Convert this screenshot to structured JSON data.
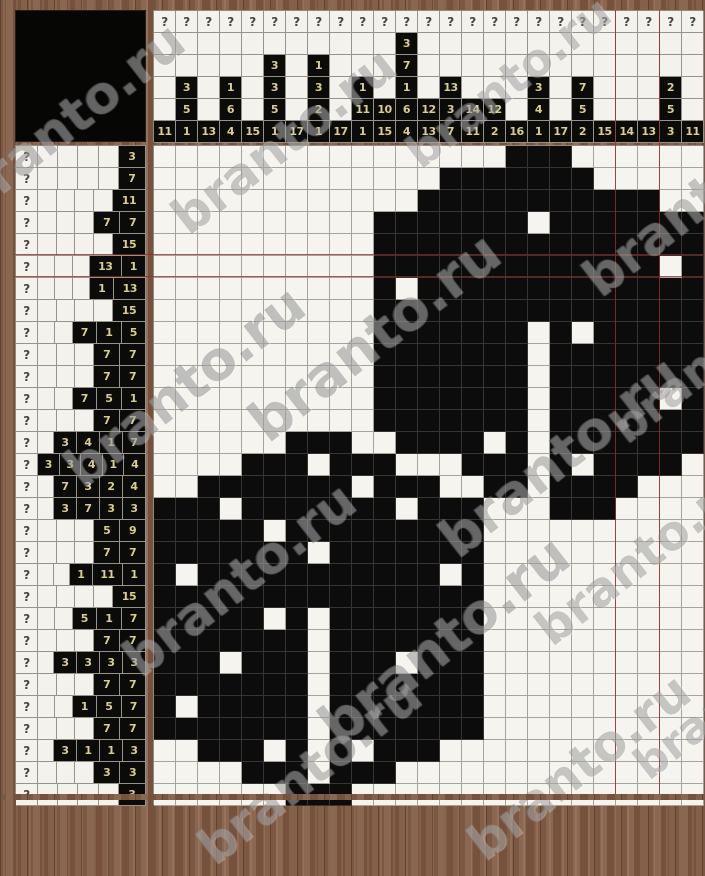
{
  "site": {
    "watermark_text": "branto.ru"
  },
  "puzzle": {
    "rows": 30,
    "cols": 25,
    "hidden_clue_symbol": "?",
    "column_clues": [
      [
        11
      ],
      [
        3,
        5,
        1
      ],
      [
        13
      ],
      [
        1,
        6,
        4
      ],
      [
        15
      ],
      [
        3,
        3,
        5,
        1
      ],
      [
        17
      ],
      [
        1,
        3,
        2,
        1
      ],
      [
        17
      ],
      [
        1,
        11,
        1
      ],
      [
        10,
        15
      ],
      [
        3,
        7,
        1,
        6,
        4
      ],
      [
        12,
        13
      ],
      [
        13,
        3,
        7
      ],
      [
        14,
        11
      ],
      [
        12,
        2
      ],
      [
        16
      ],
      [
        3,
        4,
        1
      ],
      [
        17
      ],
      [
        7,
        5,
        2
      ],
      [
        15
      ],
      [
        14
      ],
      [
        13
      ],
      [
        2,
        5,
        3
      ],
      [
        11
      ]
    ],
    "row_clues": [
      [
        3
      ],
      [
        7
      ],
      [
        11
      ],
      [
        7,
        7
      ],
      [
        15
      ],
      [
        13,
        1
      ],
      [
        1,
        13
      ],
      [
        15
      ],
      [
        7,
        1,
        5
      ],
      [
        7,
        7
      ],
      [
        7,
        7
      ],
      [
        7,
        5,
        1
      ],
      [
        7,
        7
      ],
      [
        3,
        4,
        1,
        7
      ],
      [
        3,
        3,
        4,
        1,
        4
      ],
      [
        7,
        3,
        2,
        4
      ],
      [
        3,
        7,
        3,
        3
      ],
      [
        5,
        9
      ],
      [
        7,
        7
      ],
      [
        1,
        11,
        1
      ],
      [
        15
      ],
      [
        5,
        1,
        7
      ],
      [
        7,
        7
      ],
      [
        3,
        3,
        3,
        3
      ],
      [
        7,
        7
      ],
      [
        1,
        5,
        7
      ],
      [
        7,
        7
      ],
      [
        3,
        1,
        1,
        3
      ],
      [
        3,
        3
      ],
      [
        3
      ]
    ],
    "grid": [
      "0000000000000000111000000",
      "0000000000000111111100000",
      "0000000000001111111111100",
      "0000000000111111101111111",
      "0000000000111111111111111",
      "0000000000111111111111101",
      "0000000000101111111111111",
      "0000000000111111111111111",
      "0000000000111111101011111",
      "0000000000111111101111111",
      "0000000000111111101111111",
      "0000000000111111101111101",
      "0000000000111111101111111",
      "0000001110011110101111111",
      "0000111011100011101011110",
      "0011111110111001101111000",
      "1110111111101110001110000",
      "1111101111111110000000000",
      "1111111011111110000000000",
      "1011111111111010000000000",
      "1111111111111110000000000",
      "1111101011111110000000000",
      "1111111011111110000000000",
      "1110111011101110000000000",
      "1111111011111110000000000",
      "1011111011111110000000000",
      "1111111011111110000000000",
      "0011101010111000000000000",
      "0000111011100000000000000",
      "0000001110000000000000000"
    ],
    "colors": {
      "clue_cell_bg": "#0b0b0a",
      "clue_text": "#d9cd8f",
      "cell_white": "#f6f4ef",
      "cell_black": "#0c0c0c",
      "accent_line": "#8b2822",
      "wood": "#7b5843"
    }
  }
}
